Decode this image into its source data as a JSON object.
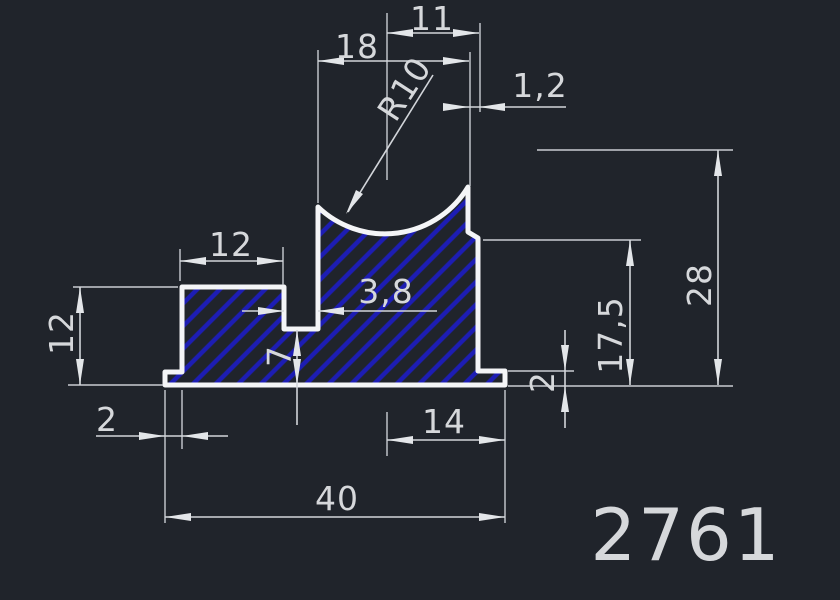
{
  "drawing": {
    "type": "cad-profile-cross-section",
    "part_number": "2761",
    "colors": {
      "background": "#20242b",
      "profile_outline": "#f4f5f7",
      "hatch": "#1d1db4",
      "dimension_lines": "#d2d5da",
      "dimension_text": "#d6d8db"
    },
    "dimensions": {
      "top_notch_width": "11",
      "top_opening_width": "18",
      "curve_radius": "R10",
      "right_step_width": "1,2",
      "left_block_top_width": "12",
      "slot_width": "3,8",
      "left_block_height": "12",
      "slot_floor_thickness": "7",
      "left_foot_offset": "2",
      "bottom_right_width": "14",
      "total_width": "40",
      "right_foot_height": "2",
      "right_step_height": "17,5",
      "total_height": "28"
    }
  }
}
